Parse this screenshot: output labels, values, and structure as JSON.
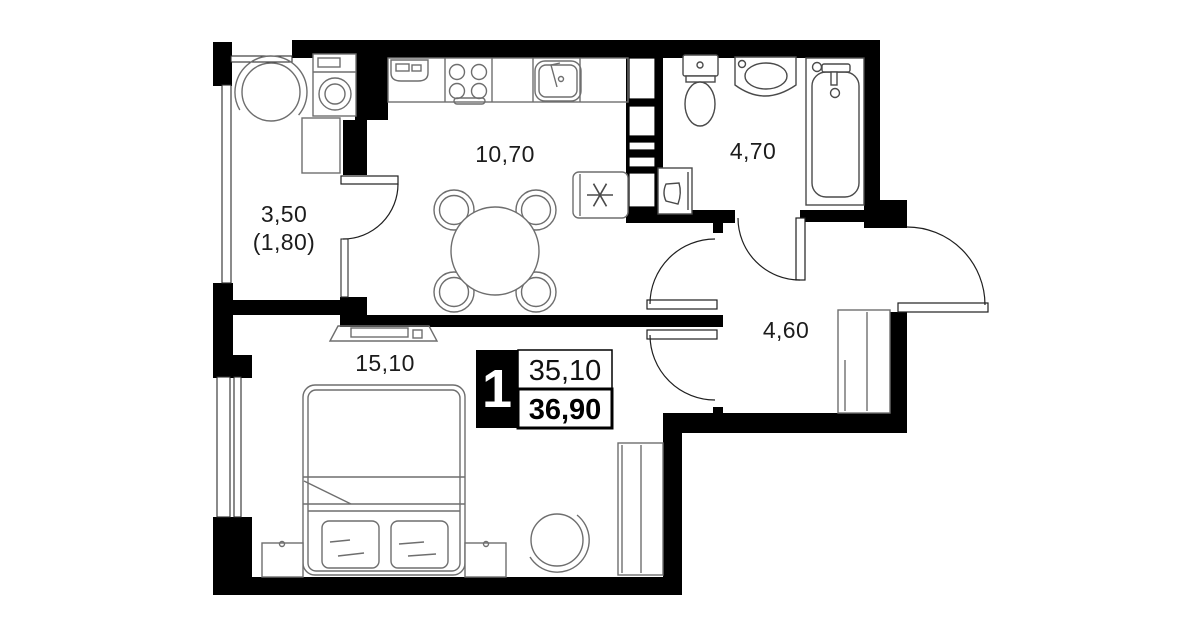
{
  "plan": {
    "title": "one-room apartment floor plan",
    "badge": {
      "rooms": "1",
      "area_living": "35,10",
      "area_total": "36,90"
    },
    "rooms": [
      {
        "id": "balcony",
        "area": "3,50",
        "area_reduced": "(1,80)"
      },
      {
        "id": "kitchen_living",
        "area": "10,70"
      },
      {
        "id": "bathroom",
        "area": "4,70"
      },
      {
        "id": "hallway",
        "area": "4,60"
      },
      {
        "id": "bedroom",
        "area": "15,10"
      }
    ],
    "colors": {
      "walls": "#000000",
      "background": "#ffffff",
      "furniture_outline": "#6e6e6e",
      "fixture_outline": "#4a4a4a",
      "door_arc": "#1f1f1f",
      "badge_bg": "#000000",
      "badge_text": "#ffffff"
    },
    "icons": {
      "fridge": "six-spoke-asterisk",
      "stove": "four-burner-circles",
      "dining_table": "circle-with-four-chair-arcs",
      "bed": "double-bed-with-two-pillows",
      "washing_machine": "box-with-concentric-circles",
      "bathtub": "rounded-tub-with-faucet",
      "toilet": "tank-and-oval-bowl",
      "washbasin": "vanity-with-oval-basin",
      "wardrobe": "rect-with-vertical-dividers",
      "tv": "trapezoid-stand-with-screen"
    }
  }
}
